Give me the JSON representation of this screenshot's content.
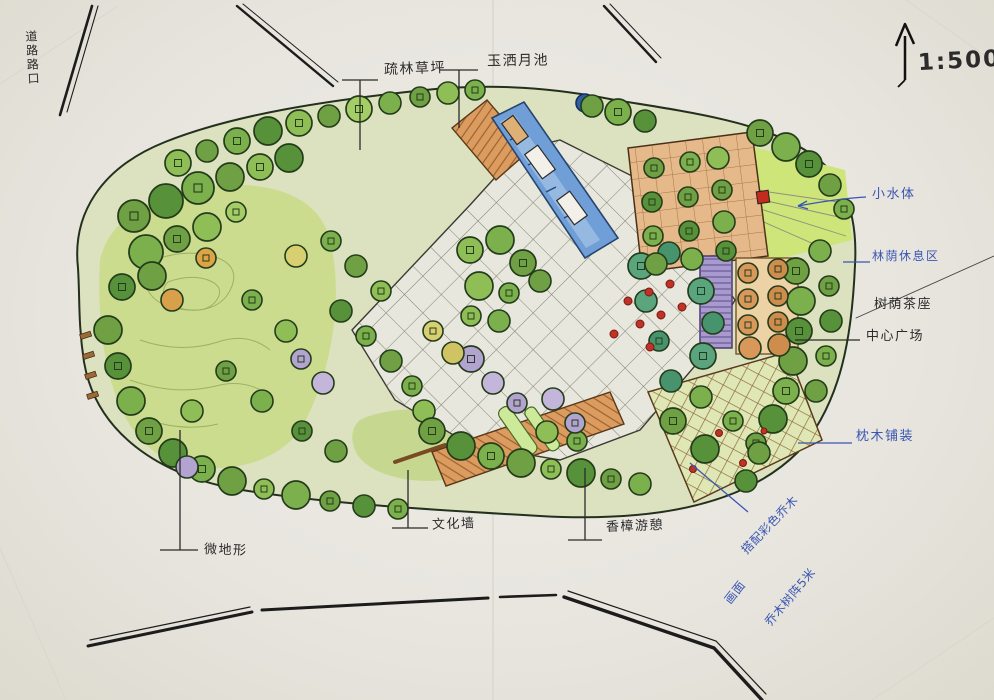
{
  "document": {
    "type": "hand-drawn landscape masterplan sketch",
    "media": "marker and ink on folded paper"
  },
  "scale": {
    "ratio": "1:500",
    "north_arrow": "up"
  },
  "annotations": {
    "corner": {
      "text": "道路路口"
    },
    "top": [
      {
        "id": "sparse-woods-lawn",
        "text": "疏林草坪"
      },
      {
        "id": "moon-pool",
        "text": "玉洒月池"
      }
    ],
    "right": [
      {
        "id": "small-water",
        "text": "小水体",
        "pen": "blue"
      },
      {
        "id": "shade-rest-area",
        "text": "林荫休息区",
        "pen": "blue"
      },
      {
        "id": "tree-shade-seats",
        "text": "树荫茶座",
        "pen": "black"
      },
      {
        "id": "central-plaza",
        "text": "中心广场",
        "pen": "black"
      },
      {
        "id": "sleeper-wood-paving",
        "text": "枕木铺装",
        "pen": "blue"
      }
    ],
    "bottom": [
      {
        "id": "micro-terrain",
        "text": "微地形"
      },
      {
        "id": "culture-wall",
        "text": "文化墙"
      },
      {
        "id": "camphor-rest",
        "text": "香樟游憩"
      }
    ],
    "sketch_notes": [
      {
        "id": "color-trees-note",
        "text": "搭配彩色乔木",
        "pen": "blue"
      },
      {
        "id": "picture-note",
        "text": "画面",
        "pen": "blue"
      },
      {
        "id": "tree-grid-note",
        "text": "乔木树阵5米",
        "pen": "blue"
      }
    ]
  },
  "palette": {
    "paper": "#e9e7e1",
    "ink": "#2b2b2b",
    "blue_pen": "#3a56b4",
    "tree_green": "#6fa043",
    "lawn_green": "#cbdc8e",
    "water_blue": "#6f9fd6",
    "deck_orange": "#dc9c5f",
    "pergola_purple": "#a99ace",
    "accent_red": "#c0392b"
  }
}
